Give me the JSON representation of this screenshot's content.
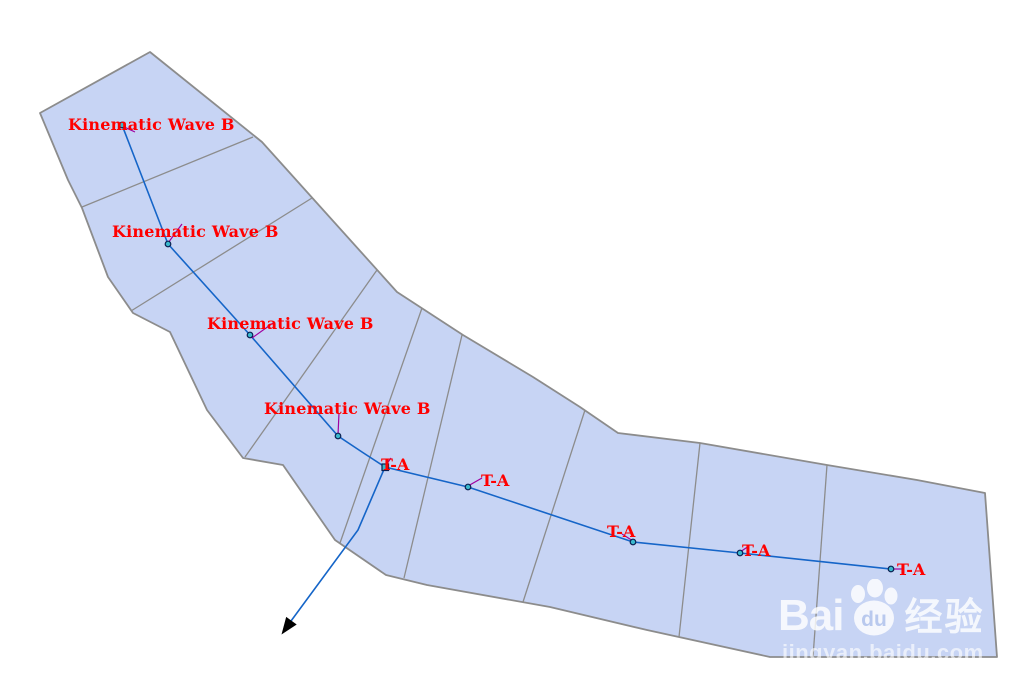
{
  "diagram": {
    "subbasin_labels": [
      {
        "text": "Kinematic Wave B"
      },
      {
        "text": "Kinematic Wave B"
      },
      {
        "text": "Kinematic Wave B"
      },
      {
        "text": "Kinematic Wave B"
      }
    ],
    "reach_labels": [
      {
        "text": "T-A"
      },
      {
        "text": "T-A"
      },
      {
        "text": "T-A"
      },
      {
        "text": "T-A"
      },
      {
        "text": "T-A"
      }
    ],
    "colors": {
      "basin_fill": "#C7D4F4",
      "boundary": "#8C8C8C",
      "divider": "#8C8C8C",
      "river": "#1565C8",
      "node_fill": "#3AB8CC",
      "node_stroke": "#0A1E50",
      "leader": "#A000A0",
      "label_text": "#FF0000",
      "arrow": "#000000"
    }
  },
  "watermark": {
    "brand_prefix": "Bai",
    "brand_du": "du",
    "brand_suffix": "经验",
    "url": "jingyan.baidu.com"
  }
}
